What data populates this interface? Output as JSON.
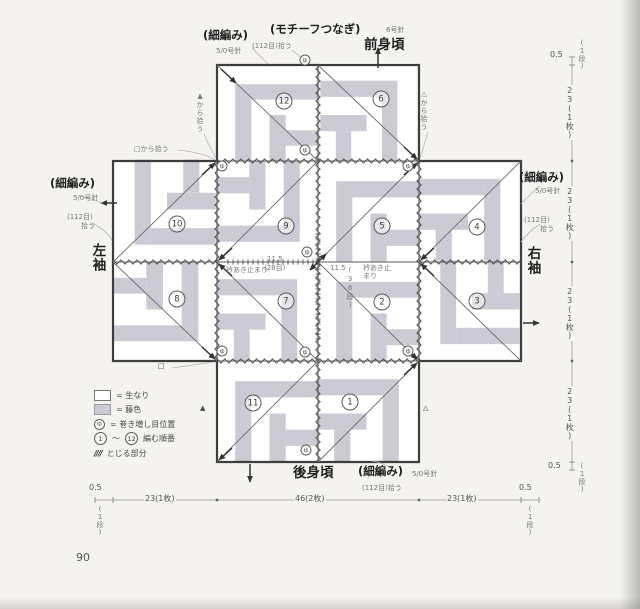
{
  "colors": {
    "wisteria": "#cbcad5",
    "natural": "#ffffff",
    "line": "#4b4b4b"
  },
  "page_number": "90",
  "sections": {
    "front": "前身頃",
    "back": "後身頃",
    "left": "左袖",
    "right": "右袖"
  },
  "technique": {
    "sc": "(細編み)",
    "hook": "5/0号針",
    "pickup": "(112目)拾う",
    "pickup_sts": "(112目)",
    "pickup_verb": "拾う",
    "motif_join": "(モチーフつなぎ)",
    "needle6": "6号針"
  },
  "pickup_notes": {
    "from_square": "□から拾う",
    "from_tri_filled": "▲から拾う",
    "from_tri_open": "△から拾う"
  },
  "anchors": {
    "square": "□",
    "tri_filled": "▲",
    "tri_open": "△"
  },
  "neck": {
    "stop": "衿あき止まり",
    "w": "11.5",
    "w_sub": "(28目)",
    "h": "11.5",
    "h_sub": "(36段)"
  },
  "legend": {
    "natural": "= 生なり",
    "wisteria": "= 藤色",
    "wrap": "= 巻き増し目位置",
    "order_from": "1",
    "order_to": "12",
    "tilde": "〜",
    "order": "編む順番",
    "hatch_symbol": "////",
    "hatch": "とじる部分"
  },
  "wrap_mark": "ゆ",
  "squares": [
    {
      "n": "12"
    },
    {
      "n": "6"
    },
    {
      "n": "10"
    },
    {
      "n": "9"
    },
    {
      "n": "5"
    },
    {
      "n": "4"
    },
    {
      "n": "8"
    },
    {
      "n": "7"
    },
    {
      "n": "2"
    },
    {
      "n": "3"
    },
    {
      "n": "11"
    },
    {
      "n": "1"
    }
  ],
  "measures": {
    "half": "0.5",
    "half_unit": "(1段)",
    "w23": "23(1枚)",
    "w46": "46(2枚)"
  }
}
